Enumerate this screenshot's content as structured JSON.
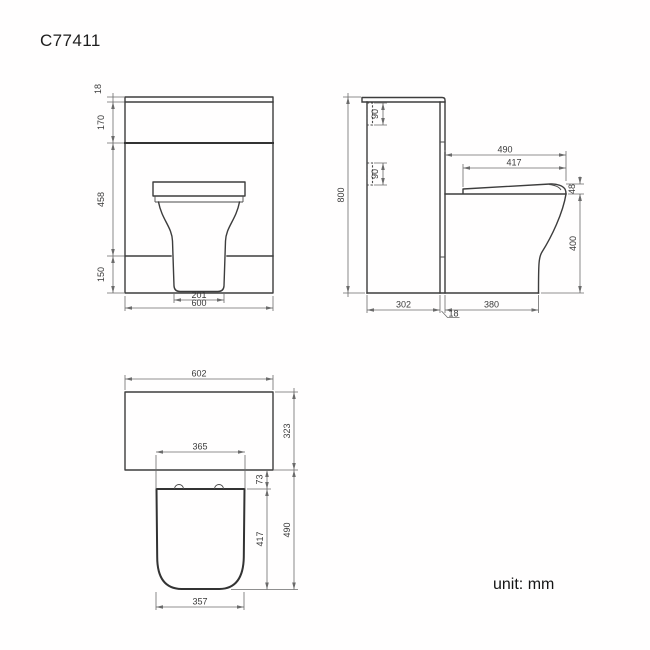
{
  "title": "C77411",
  "unit_note": "unit: mm",
  "colors": {
    "background": "#ffffff",
    "object_line": "#3d3d3d",
    "dimension_line": "#6b6b6b",
    "text": "#3a3a3a"
  },
  "front_view": {
    "name": "front-elevation",
    "dims": {
      "worktop_thickness": "18",
      "upper_height": "170",
      "middle_height": "458",
      "plinth_height": "150",
      "pan_width": "201",
      "overall_width": "600"
    }
  },
  "side_view": {
    "name": "side-elevation",
    "dims": {
      "overall_height": "800",
      "bracket_top": "90",
      "bracket_bottom": "90",
      "seat_overall": "490",
      "seat_length": "417",
      "seat_thickness": "48",
      "pan_height": "400",
      "unit_depth": "302",
      "pan_projection": "380",
      "panel_thickness": "18"
    }
  },
  "plan_view": {
    "name": "plan-view",
    "dims": {
      "overall_width": "602",
      "unit_depth": "323",
      "seat_back_width": "365",
      "hinge_depth": "73",
      "seat_depth": "417",
      "overall_projection": "490",
      "seat_front_width": "357"
    }
  }
}
